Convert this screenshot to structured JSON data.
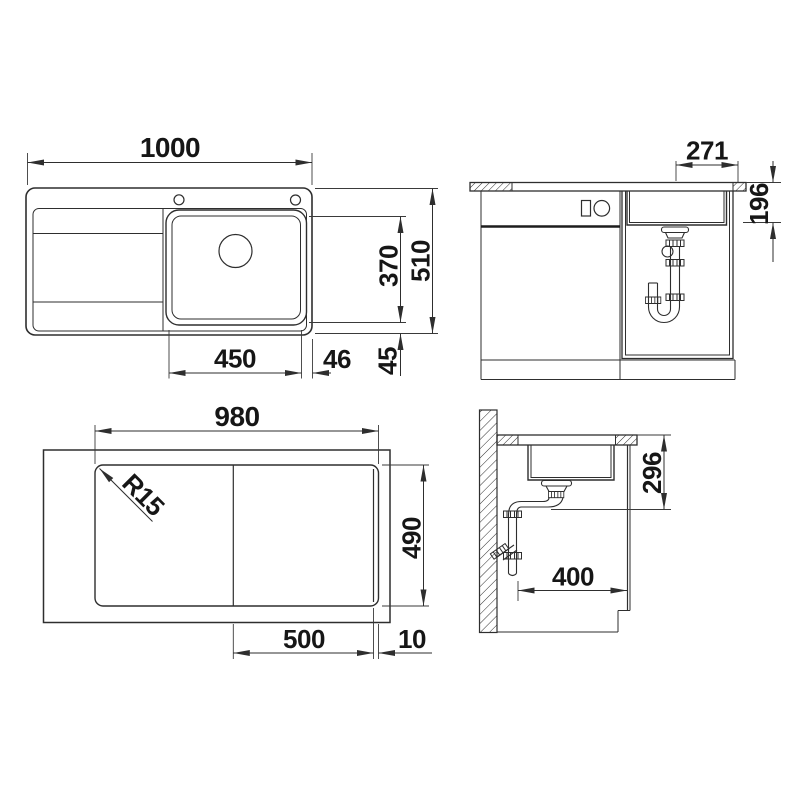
{
  "drawing": {
    "background": "#ffffff",
    "line_color": "#2e2e2e",
    "text_color": "#161616",
    "views": {
      "plan": {
        "overall_width": "1000",
        "overall_depth": "510",
        "bowl_depth": "370",
        "bowl_width": "450",
        "bowl_gap_right": "46",
        "bowl_gap_front": "45"
      },
      "front_section": {
        "drain_to_right_edge": "271",
        "depth_under_counter": "196"
      },
      "cutout_plan": {
        "cutout_width": "980",
        "cutout_depth": "490",
        "corner_radius": "R15",
        "bowl_zone_width": "500",
        "edge_strip": "10"
      },
      "side_section": {
        "depth_under_counter": "296",
        "wall_clearance": "400"
      }
    }
  }
}
